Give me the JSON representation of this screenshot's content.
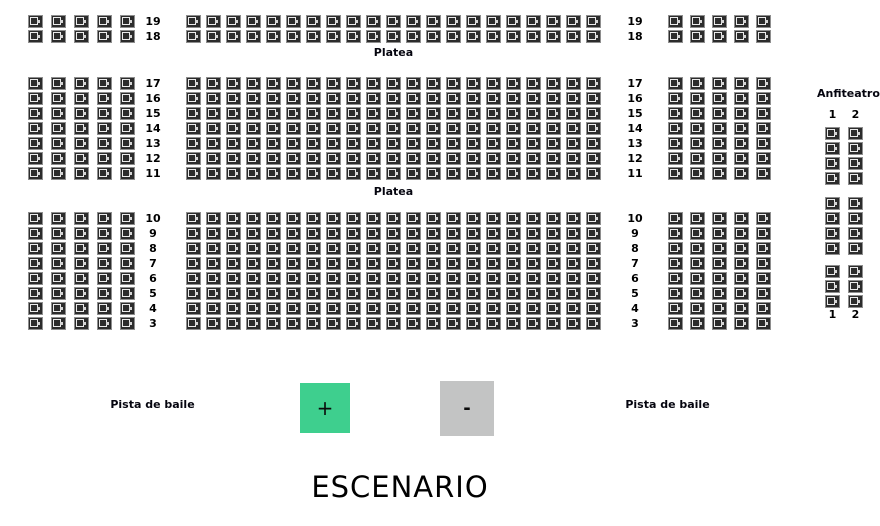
{
  "labels": {
    "platea_top": "Platea",
    "platea_middle": "Platea",
    "anfiteatro": "Anfiteatro",
    "pista_de_baile_left": "Pista de baile",
    "pista_de_baile_right": "Pista de baile",
    "escenario": "ESCENARIO"
  },
  "controls": {
    "zoom_in_label": "+",
    "zoom_out_label": "-"
  },
  "colors": {
    "zoom_in_bg": "#3ecf8e",
    "zoom_out_bg": "#c3c4c4",
    "seat_fill": "#2c2c2c",
    "seat_border": "#8e8e8e"
  },
  "row_numbers": {
    "top": [
      "19",
      "18"
    ],
    "middle": [
      "17",
      "16",
      "15",
      "14",
      "13",
      "12",
      "11"
    ],
    "bottom": [
      "10",
      "9",
      "8",
      "7",
      "6",
      "5",
      "4",
      "3"
    ]
  },
  "anfiteatro": {
    "column_headers": [
      "1",
      "2"
    ],
    "column_footers": [
      "1",
      "2"
    ]
  },
  "seat_blocks": {
    "top-left": {
      "rows": 2,
      "cols": 5
    },
    "top-center": {
      "rows": 2,
      "cols": 21
    },
    "top-right": {
      "rows": 2,
      "cols": 5
    },
    "middle-left": {
      "rows": 7,
      "cols": 5
    },
    "middle-center": {
      "rows": 7,
      "cols": 21
    },
    "middle-right": {
      "rows": 7,
      "cols": 5
    },
    "bottom-left": {
      "rows": 8,
      "cols": 5
    },
    "bottom-center": {
      "rows": 8,
      "cols": 21
    },
    "bottom-right": {
      "rows": 8,
      "cols": 5
    },
    "anfiteatro-group-1": {
      "rows": 4,
      "cols": 2
    },
    "anfiteatro-group-2": {
      "rows": 4,
      "cols": 2
    },
    "anfiteatro-group-3": {
      "rows": 3,
      "cols": 2
    }
  }
}
